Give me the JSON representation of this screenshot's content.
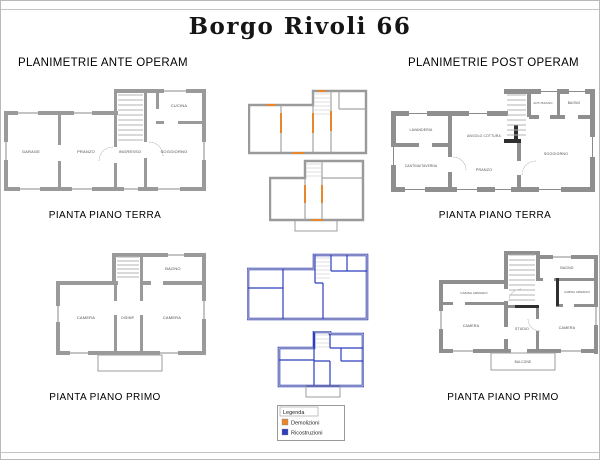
{
  "title": "Borgo Rivoli 66",
  "ante": {
    "header": "PLANIMETRIE ANTE OPERAM",
    "ground_floor_caption": "PIANTA PIANO TERRA",
    "first_floor_caption": "PIANTA PIANO PRIMO",
    "ground_rooms": {
      "garage": "GARAGE",
      "pranzo": "PRANZO",
      "ingresso": "INGRESSO",
      "soggiorno": "SOGGIORNO",
      "cucina": "CUCINA"
    },
    "first_rooms": {
      "camera_sx": "CAMERA",
      "disimpegno": "DISIMP.",
      "camera_dx": "CAMERA",
      "bagno": "BAGNO"
    }
  },
  "post": {
    "header": "PLANIMETRIE POST OPERAM",
    "ground_floor_caption": "PIANTA PIANO TERRA",
    "first_floor_caption": "PIANTA PIANO PRIMO",
    "ground_rooms": {
      "lavanderia": "LAVANDERIA",
      "cantina_taverna": "CANTINA/TAVERNA",
      "angolo_cottura": "ANGOLO COTTURA",
      "pranzo": "PRANZO",
      "anti_bagno": "ANTI BAGNO",
      "bagno": "BAGNO",
      "soggiorno": "SOGGIORNO"
    },
    "first_rooms": {
      "cabina_armadio_sx": "CABINA ARMADIO",
      "camera_sx": "CAMERA",
      "studio": "STUDIO",
      "bagno": "BAGNO",
      "cabina_armadio_dx": "CABINA ARMADIO",
      "camera_dx": "CAMERA",
      "balcone": "BALCONE"
    }
  },
  "legend": {
    "title": "Legenda",
    "items": [
      {
        "label": "Demolizioni",
        "color": "#E8862C"
      },
      {
        "label": "Ricostruzioni",
        "color": "#2E3DBE"
      }
    ]
  },
  "colors": {
    "demolition": "#E8862C",
    "reconstruction": "#2E3DBE",
    "wall_gray": "#9A9A9A",
    "background": "#FFFFFF"
  }
}
